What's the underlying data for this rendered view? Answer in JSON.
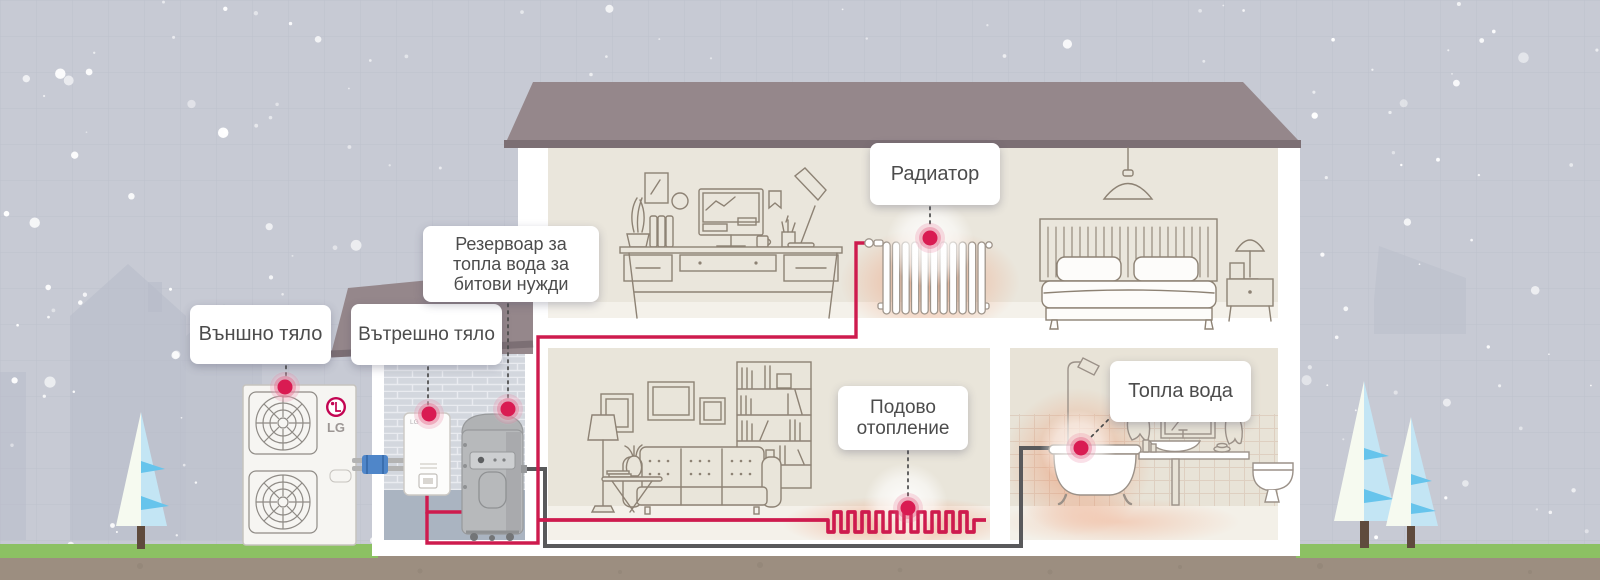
{
  "callouts": {
    "outdoor_unit": {
      "label": "Външно тяло"
    },
    "indoor_unit": {
      "label": "Вътрешно тяло"
    },
    "dhw_tank": {
      "line1": "Резервоар за",
      "line2": "топла вода за",
      "line3": "битови нужди"
    },
    "radiator": {
      "label": "Радиатор"
    },
    "floor_heating": {
      "line1": "Подово",
      "line2": "отопление"
    },
    "hot_water": {
      "label": "Топла вода"
    }
  },
  "branding": {
    "outdoor_unit_logo": "LG",
    "indoor_unit_logo": "LG"
  },
  "markers": {
    "style": "red-hotspot-dot",
    "count": 6,
    "items": [
      "outdoor-unit",
      "indoor-unit",
      "dhw-tank",
      "radiator",
      "floor-heating",
      "hot-water"
    ]
  },
  "colors": {
    "sky_gray": "#c7cad4",
    "roof_mauve": "#95878b",
    "room_beige": "#eae6dc",
    "grass_green": "#8cc163",
    "soil_brown": "#9c8e80",
    "pipe_red": "#ce1b4e",
    "pipe_dark_gray": "#59595b",
    "marker_red": "#d91b52",
    "lg_logo_red": "#c30452",
    "tree_blue": "#c3e5f4"
  }
}
